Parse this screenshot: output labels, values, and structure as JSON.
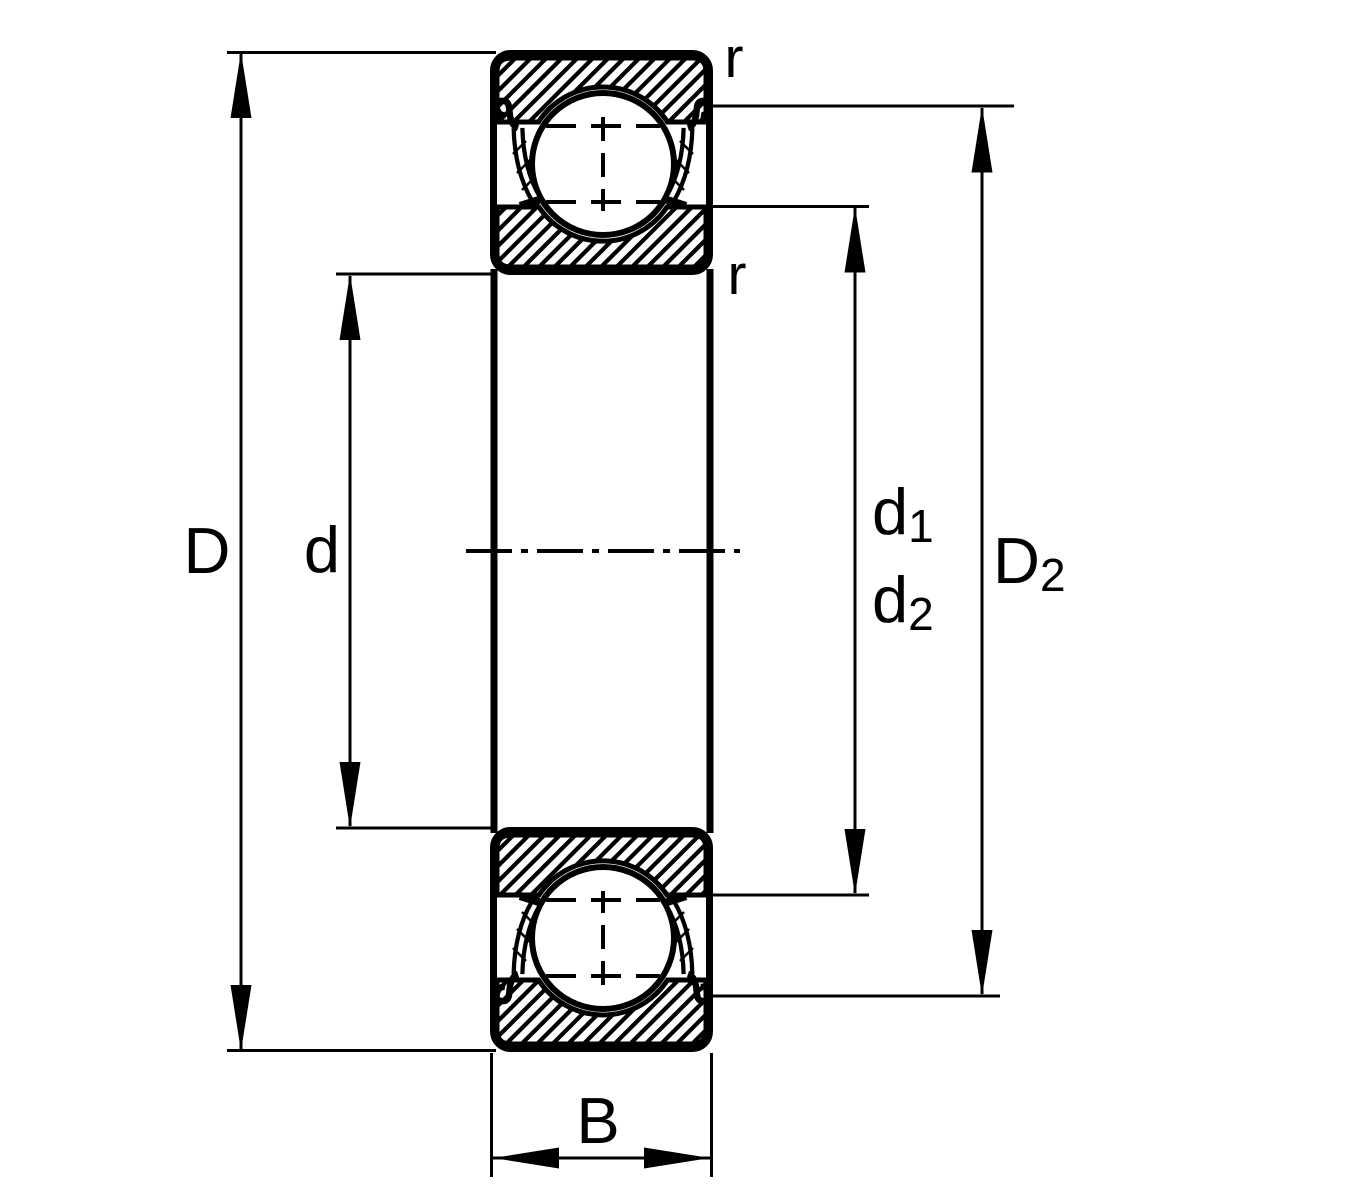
{
  "diagram": {
    "description": "Deep groove ball bearing cross-section with shields, dimension drawing",
    "colors": {
      "line": "#000000",
      "background": "#ffffff"
    },
    "labels": {
      "outer_diameter": "D",
      "bore_diameter": "d",
      "d1_main": "d",
      "d1_sub": "1",
      "d2_main": "d",
      "d2_sub": "2",
      "D2_main": "D",
      "D2_sub": "2",
      "width": "B",
      "r_top": "r",
      "r_bottom": "r"
    }
  }
}
